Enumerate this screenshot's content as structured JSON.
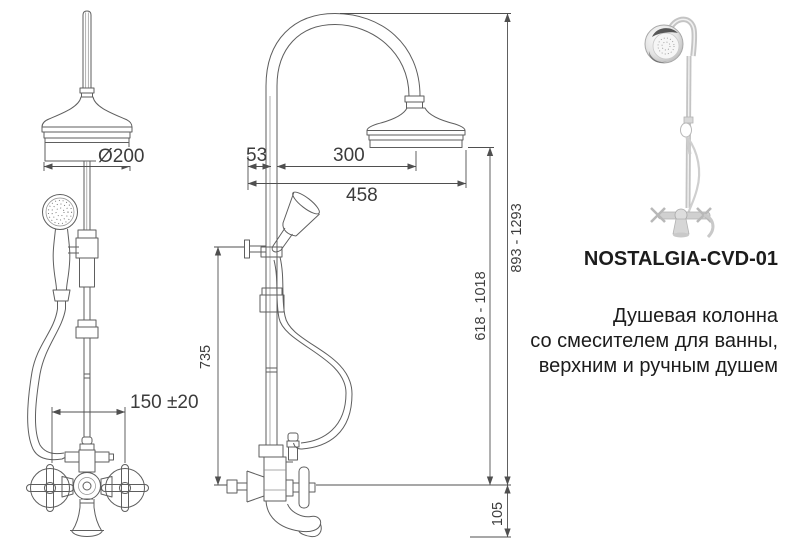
{
  "product": {
    "model": "NOSTALGIA-CVD-01",
    "description_lines": [
      "Душевая колонна",
      "со смесителем для ванны,",
      "верхним и ручным душем"
    ]
  },
  "dimensions": {
    "front_view": {
      "head_diameter": "Ø200",
      "inlet_spacing": "150 ±20"
    },
    "side_view": {
      "wall_to_column": "53",
      "column_to_head_center": "300",
      "overall_reach": "458",
      "column_to_mixer_height": "735",
      "head_to_mixer_height": "618 - 1018",
      "overall_height": "893 - 1293",
      "mixer_to_spout_drop": "105"
    }
  },
  "colors": {
    "background": "#ffffff",
    "drawing_line": "#5e5e5e",
    "dimension_line": "#4f4f4f",
    "text": "#1c1c1c"
  }
}
